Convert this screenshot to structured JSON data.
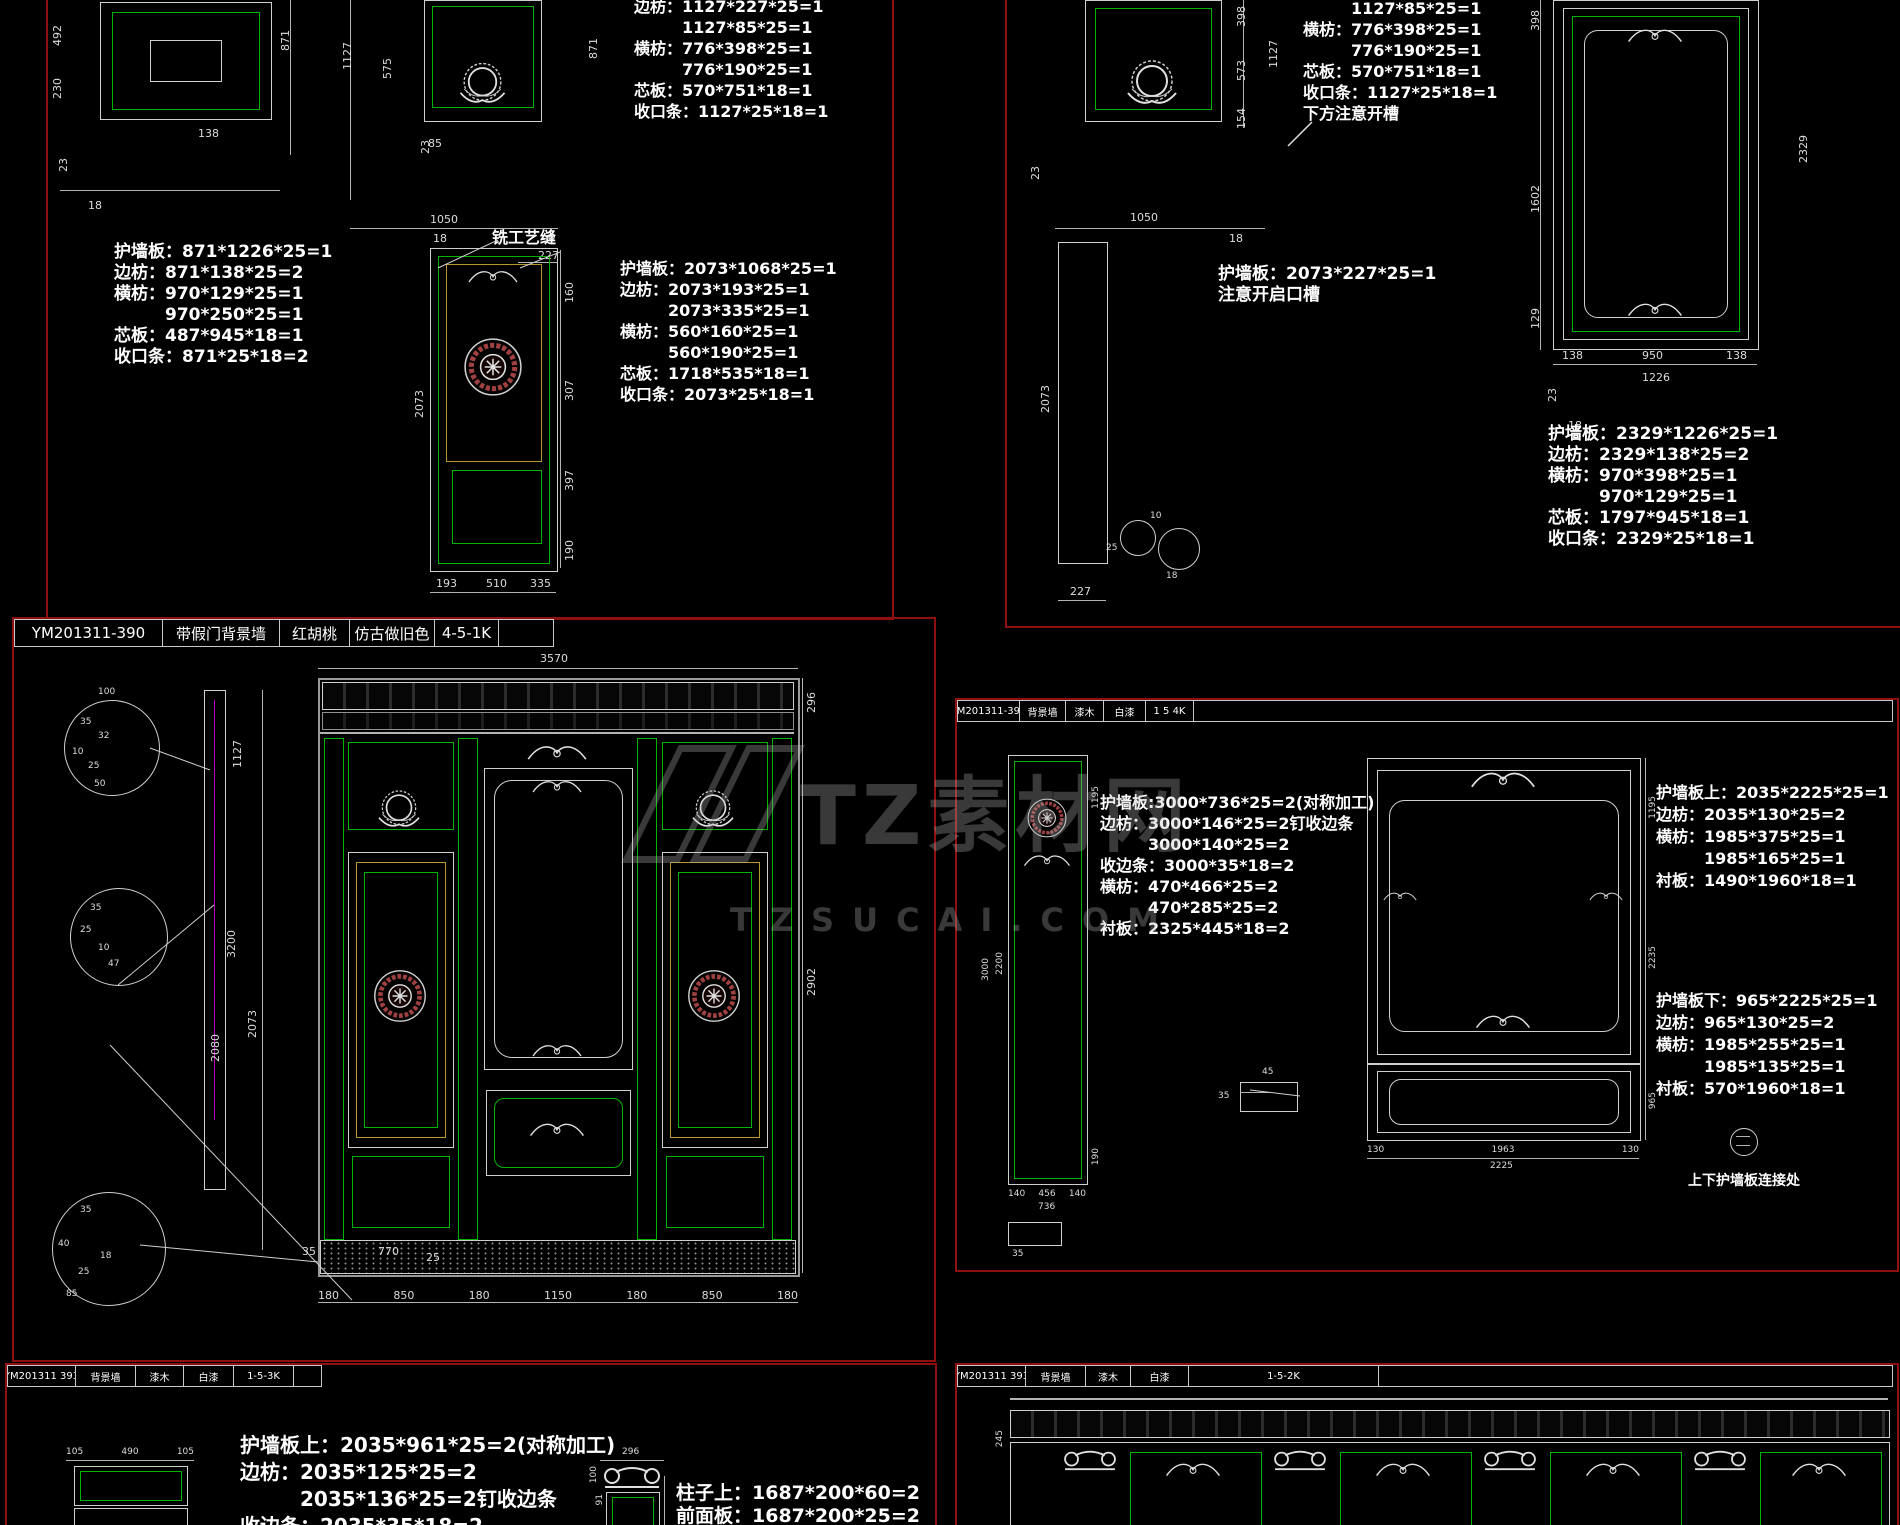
{
  "watermark": {
    "brand": "TZ素材网",
    "domain": "TZSUCAI.COM"
  },
  "titles": {
    "main": [
      "YM201311-390",
      "带假门背景墙",
      "红胡桃",
      "仿古做旧色",
      "4-5-1K"
    ],
    "right": [
      "YM201311-393",
      "背景墙",
      "漆木",
      "白漆",
      "1 5 4K"
    ],
    "bottom_left": [
      "YM201311 393",
      "背景墙",
      "漆木",
      "白漆",
      "1-5-3K"
    ],
    "bottom_right": [
      "YM201311 393",
      "背景墙",
      "漆木",
      "白漆",
      "1-5-2K"
    ]
  },
  "blocks": {
    "tl_left": [
      "护墙板：871*1226*25=1",
      "边枋：871*138*25=2",
      "横枋：970*129*25=1",
      "　　　970*250*25=1",
      "芯板：487*945*18=1",
      "收口条：871*25*18=2"
    ],
    "tl_top": [
      "边枋：1127*227*25=1",
      "　　　1127*85*25=1",
      "横枋：776*398*25=1",
      "　　　776*190*25=1",
      "芯板：570*751*18=1",
      "收口条：1127*25*18=1"
    ],
    "tl_mid": [
      "护墙板：2073*1068*25=1",
      "边枋：2073*193*25=1",
      "　　　2073*335*25=1",
      "横枋：560*160*25=1",
      "　　　560*190*25=1",
      "芯板：1718*535*18=1",
      "收口条：2073*25*18=1"
    ],
    "tr_top": [
      "　　　1127*85*25=1",
      "横枋：776*398*25=1",
      "　　　776*190*25=1",
      "芯板：570*751*18=1",
      "收口条：1127*25*18=1",
      "下方注意开槽"
    ],
    "tr_mid": [
      "护墙板：2073*227*25=1",
      "注意开启口槽"
    ],
    "tr_right": [
      "护墙板：2329*1226*25=1",
      "边枋：2329*138*25=2",
      "横枋：970*398*25=1",
      "　　　970*129*25=1",
      "芯板：1797*945*18=1",
      "收口条：2329*25*18=1"
    ],
    "mr_left": [
      "护墙板:3000*736*25=2(对称加工)",
      "边枋：3000*146*25=2钉收边条",
      "　　　3000*140*25=2",
      "收边条：3000*35*18=2",
      "横枋：470*466*25=2",
      "　　　470*285*25=2",
      "衬板：2325*445*18=2"
    ],
    "mr_upper": [
      "护墙板上：2035*2225*25=1",
      "边枋：2035*130*25=2",
      "横枋：1985*375*25=1",
      "　　　1985*165*25=1",
      "衬板：1490*1960*18=1"
    ],
    "mr_lower": [
      "护墙板下：965*2225*25=1",
      "边枋：965*130*25=2",
      "横枋：1985*255*25=1",
      "　　　1985*135*25=1",
      "衬板：570*1960*18=1"
    ],
    "bl_wall": [
      "护墙板上：2035*961*25=2(对称加工)",
      "边枋：2035*125*25=2",
      "　　　2035*136*25=2钉收边条",
      "收边条：2035*35*18=2"
    ],
    "bl_column": [
      "柱子上：1687*200*60=2",
      "前面板：1687*200*25=2"
    ]
  },
  "notes": {
    "craft_seam": "铣工艺缝",
    "connector": "上下护墙板连接处"
  },
  "dims": {
    "tl": {
      "left_v": [
        "492",
        "230"
      ],
      "left_b": "138",
      "left_marks": [
        "23",
        "18"
      ],
      "mid_v": [
        "871",
        "1127",
        "575"
      ],
      "wreath_b": "85",
      "row": "1050",
      "seam_w": "227",
      "row_marks": [
        "23",
        "18"
      ],
      "door_right": [
        "160",
        "307",
        "397",
        "190"
      ],
      "door_left": "2073",
      "door_bottom": [
        "193",
        "510",
        "335"
      ]
    },
    "tr": {
      "wreath_right": [
        "398",
        "573",
        "154"
      ],
      "wreath_total": "1127",
      "row": [
        "23",
        "1050",
        "18"
      ],
      "strip_left": "2073",
      "strip_bottom": "227",
      "detail": [
        "10",
        "25",
        "18"
      ],
      "big_left": [
        "398",
        "1602",
        "129"
      ],
      "big_right": "2329",
      "big_bottom": [
        "138",
        "950",
        "138"
      ],
      "big_total": "1226",
      "big_marks": [
        "23",
        "18"
      ]
    },
    "main": {
      "top": "3570",
      "left": [
        "1127",
        "3200",
        "2073",
        "2080"
      ],
      "right": [
        "296",
        "2902"
      ],
      "bottom": [
        "180",
        "850",
        "180",
        "1150",
        "180",
        "850",
        "180"
      ],
      "base": [
        "35",
        "770",
        "25"
      ],
      "c1": [
        "100",
        "35",
        "32",
        "10",
        "25",
        "50"
      ],
      "c2": [
        "35",
        "25",
        "10",
        "47"
      ],
      "c3": [
        "35",
        "85",
        "40",
        "18",
        "25"
      ]
    },
    "mr": {
      "pl_left": [
        "3000",
        "2200"
      ],
      "pl_right": [
        "1195",
        "190"
      ],
      "pl_bottom": [
        "140",
        "456",
        "140"
      ],
      "pl_total": "736",
      "pl_base": "35",
      "profile": [
        "45",
        "35"
      ],
      "el_right": [
        "1195",
        "2235",
        "965"
      ],
      "el_bottom": [
        "130",
        "1963",
        "130"
      ],
      "el_total": "2225"
    },
    "bl": {
      "chain": [
        "105",
        "490",
        "105"
      ],
      "cap_top": "296",
      "cap_left": [
        "100",
        "91"
      ]
    },
    "br": {
      "left": "245"
    }
  }
}
